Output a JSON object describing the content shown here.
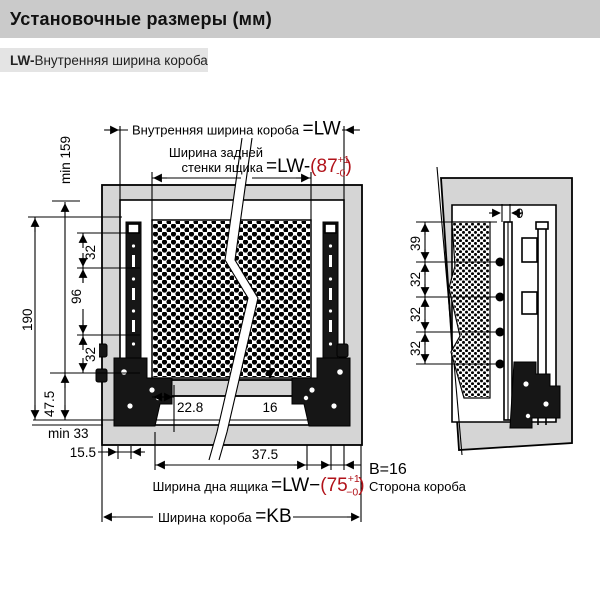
{
  "header": {
    "title": "Установочные размеры (мм)"
  },
  "subtitle": {
    "code": "LW-",
    "text": "Внутренняя ширина короба"
  },
  "front": {
    "inner_width_label": "Внутренняя ширина короба ",
    "inner_width_eq": "=LW",
    "back_wall_label1": "Ширина задней",
    "back_wall_label2": "стенки ящика",
    "back_wall_eq": "=LW-",
    "back_wall_value": "(87",
    "back_wall_tol_plus": "+1",
    "back_wall_tol_minus": "-0",
    "back_wall_close": ")",
    "min159": "min 159",
    "d190": "190",
    "d32_top": "32",
    "d96": "96",
    "d32_bottom": "32",
    "d47_5": "47.5",
    "min33": "min 33",
    "d15_5": "15.5",
    "d22_8": "22.8",
    "d16": "16",
    "d37_5": "37.5",
    "bottom_width_label": "Ширина дна ящика ",
    "bottom_width_eq": "=LW−",
    "bottom_width_value": "(75",
    "bottom_width_tol_plus": "+1",
    "bottom_width_tol_minus": "−0",
    "bottom_width_close": ")",
    "box_width_label": "Ширина короба ",
    "box_width_eq": "=KB"
  },
  "side": {
    "d9": "9",
    "d39": "39",
    "d32_1": "32",
    "d32_2": "32",
    "d32_3": "32",
    "note_b": "B=16",
    "note_side": "Сторона короба"
  },
  "colors": {
    "header_gray": "#cacaca",
    "subtitle_gray": "#e4e4e4",
    "panel_gray": "#d5d5d5",
    "accent_red": "#b11219",
    "line_black": "#000000"
  }
}
